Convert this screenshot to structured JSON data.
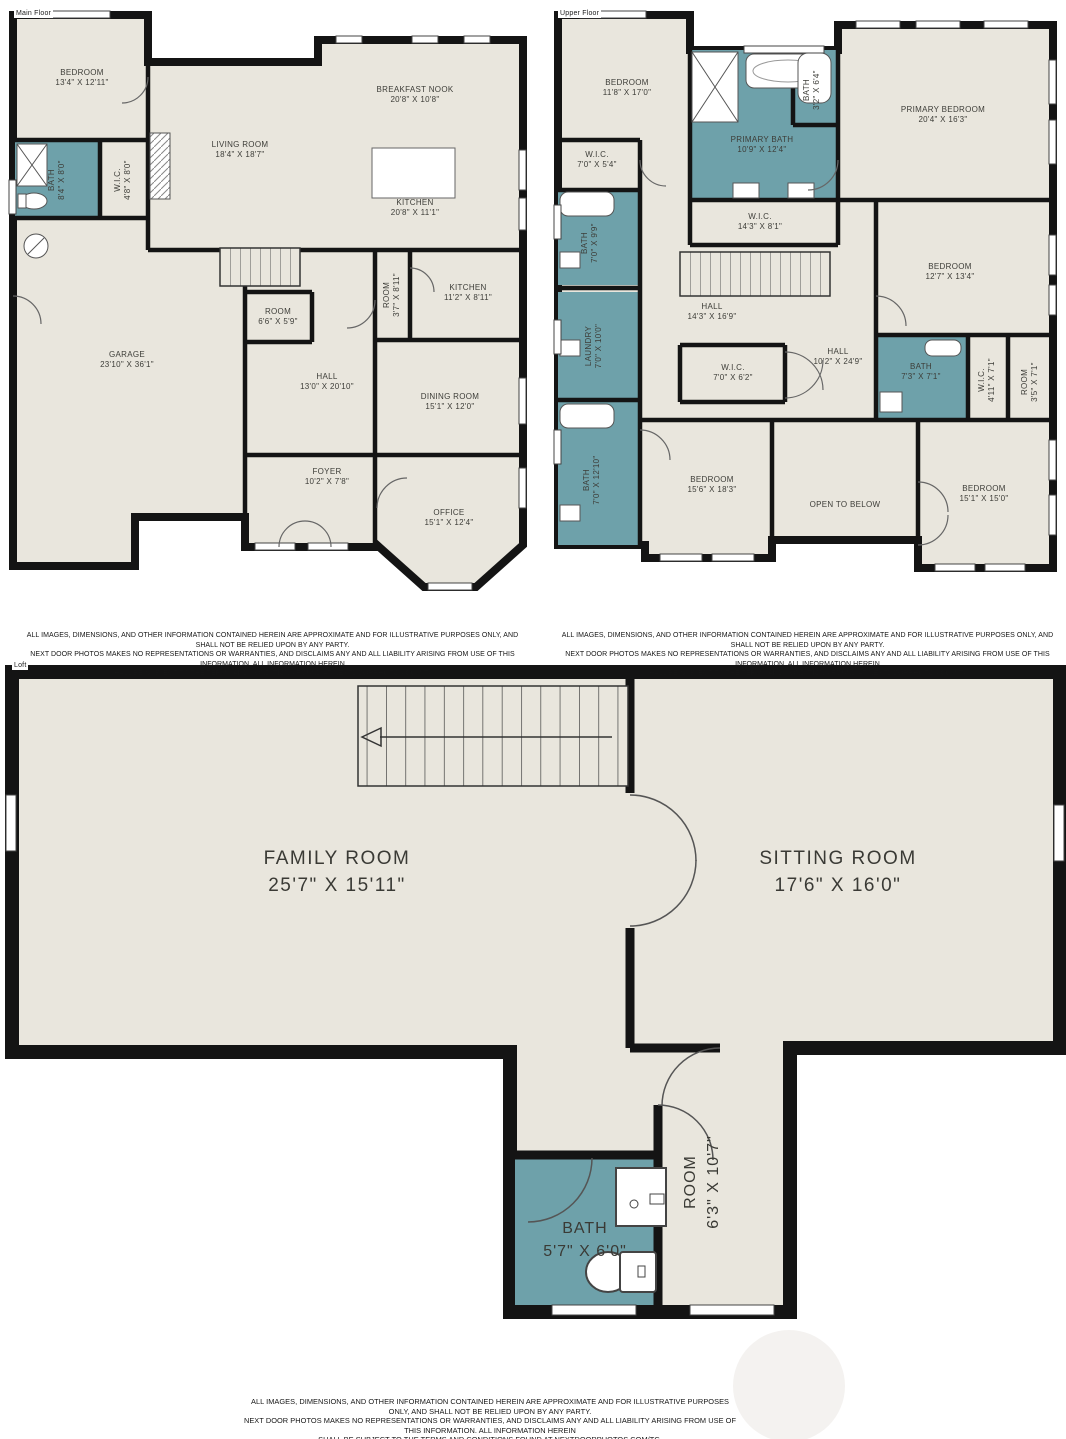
{
  "colors": {
    "floor": "#e9e6dd",
    "wall": "#141414",
    "wet_room": "#6ea1aa"
  },
  "plans": {
    "main": {
      "tag": "Main Floor",
      "rooms": [
        {
          "name": "BEDROOM",
          "dims": "13'4\" X 12'11\""
        },
        {
          "name": "BATH",
          "dims": "8'4\" X 8'0\""
        },
        {
          "name": "W.I.C.",
          "dims": "4'8\" X 8'0\""
        },
        {
          "name": "LIVING ROOM",
          "dims": "18'4\" X 18'7\""
        },
        {
          "name": "BREAKFAST NOOK",
          "dims": "20'8\" X 10'8\""
        },
        {
          "name": "KITCHEN",
          "dims": "20'8\" X 11'1\""
        },
        {
          "name": "ROOM",
          "dims": "3'7\" X 8'11\""
        },
        {
          "name": "KITCHEN",
          "dims": "11'2\" X 8'11\""
        },
        {
          "name": "ROOM",
          "dims": "6'6\" X 5'9\""
        },
        {
          "name": "GARAGE",
          "dims": "23'10\" X 36'1\""
        },
        {
          "name": "HALL",
          "dims": "13'0\" X 20'10\""
        },
        {
          "name": "DINING ROOM",
          "dims": "15'1\" X 12'0\""
        },
        {
          "name": "FOYER",
          "dims": "10'2\" X 7'8\""
        },
        {
          "name": "OFFICE",
          "dims": "15'1\" X 12'4\""
        }
      ]
    },
    "upper": {
      "tag": "Upper Floor",
      "rooms": [
        {
          "name": "BEDROOM",
          "dims": "11'8\" X 17'0\""
        },
        {
          "name": "W.I.C.",
          "dims": "7'0\" X 5'4\""
        },
        {
          "name": "PRIMARY BATH",
          "dims": "10'9\" X 12'4\""
        },
        {
          "name": "BATH",
          "dims": "3'2\" X 6'4\""
        },
        {
          "name": "PRIMARY BEDROOM",
          "dims": "20'4\" X 16'3\""
        },
        {
          "name": "W.I.C.",
          "dims": "14'3\" X 8'1\""
        },
        {
          "name": "BATH",
          "dims": "7'0\" X 9'9\""
        },
        {
          "name": "LAUNDRY",
          "dims": "7'0\" X 10'0\""
        },
        {
          "name": "HALL",
          "dims": "14'3\" X 16'9\""
        },
        {
          "name": "W.I.C.",
          "dims": "7'0\" X 6'2\""
        },
        {
          "name": "BEDROOM",
          "dims": "12'7\" X 13'4\""
        },
        {
          "name": "HALL",
          "dims": "10'2\" X 24'9\""
        },
        {
          "name": "BATH",
          "dims": "7'3\" X 7'1\""
        },
        {
          "name": "W.I.C.",
          "dims": "4'11\" X 7'1\""
        },
        {
          "name": "ROOM",
          "dims": "3'5\" X 7'1\""
        },
        {
          "name": "BEDROOM",
          "dims": "15'6\" X 18'3\""
        },
        {
          "name": "OPEN TO BELOW",
          "dims": ""
        },
        {
          "name": "BATH",
          "dims": "7'0\" X 12'10\""
        },
        {
          "name": "BEDROOM",
          "dims": "15'1\" X 15'0\""
        }
      ]
    },
    "loft": {
      "tag": "Loft",
      "rooms": [
        {
          "name": "FAMILY ROOM",
          "dims": "25'7\" X 15'11\""
        },
        {
          "name": "SITTING ROOM",
          "dims": "17'6\" X 16'0\""
        },
        {
          "name": "BATH",
          "dims": "5'7\" X 6'0\""
        },
        {
          "name": "ROOM",
          "dims": "6'3\" X 10'7\""
        }
      ]
    }
  },
  "disclaimer": {
    "line1": "ALL IMAGES, DIMENSIONS, AND OTHER INFORMATION CONTAINED HEREIN ARE APPROXIMATE AND FOR ILLUSTRATIVE PURPOSES ONLY, AND SHALL NOT BE RELIED UPON BY ANY PARTY.",
    "line2": "NEXT DOOR PHOTOS MAKES NO REPRESENTATIONS OR WARRANTIES, AND DISCLAIMS ANY AND ALL LIABILITY ARISING FROM USE OF THIS INFORMATION. ALL INFORMATION HEREIN",
    "line3": "SHALL BE SUBJECT TO THE TERMS AND CONDITIONS FOUND AT NEXTDOORPHOTOS.COM/TC."
  }
}
